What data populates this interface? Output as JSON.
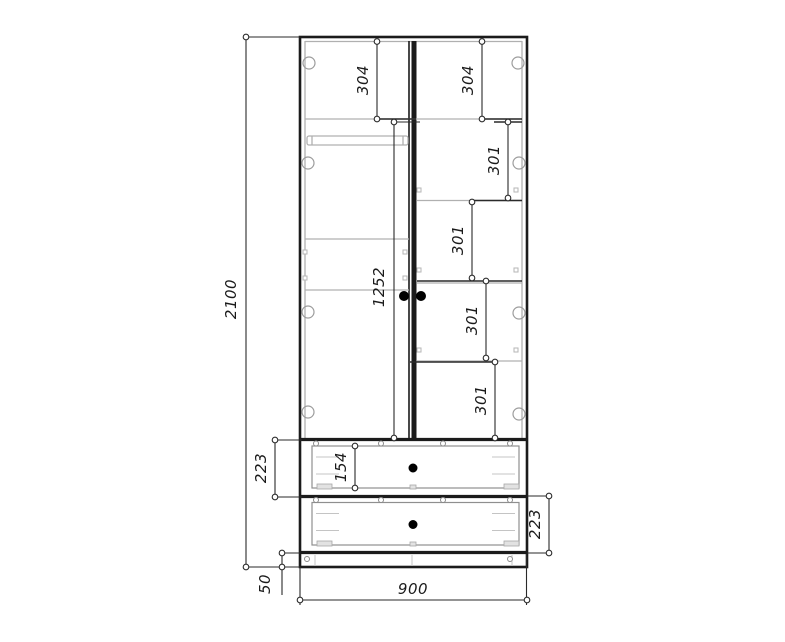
{
  "meta": {
    "drawing_type": "wardrobe front-view dimension drawing",
    "background_color": "#ffffff",
    "ink_color": "#1b1b1b",
    "light_line_color": "#b0b0b0",
    "knob_color": "#000000"
  },
  "dimensions": {
    "total_height": "2100",
    "total_width": "900",
    "plinth_height": "50",
    "left_top_compartment": "304",
    "right_top_compartment": "304",
    "right_compartment_1": "301",
    "right_compartment_2": "301",
    "right_compartment_3": "301",
    "right_compartment_4": "301",
    "door_height": "1252",
    "drawer_1_height": "223",
    "drawer_1_front_height": "154",
    "drawer_2_height": "223"
  }
}
